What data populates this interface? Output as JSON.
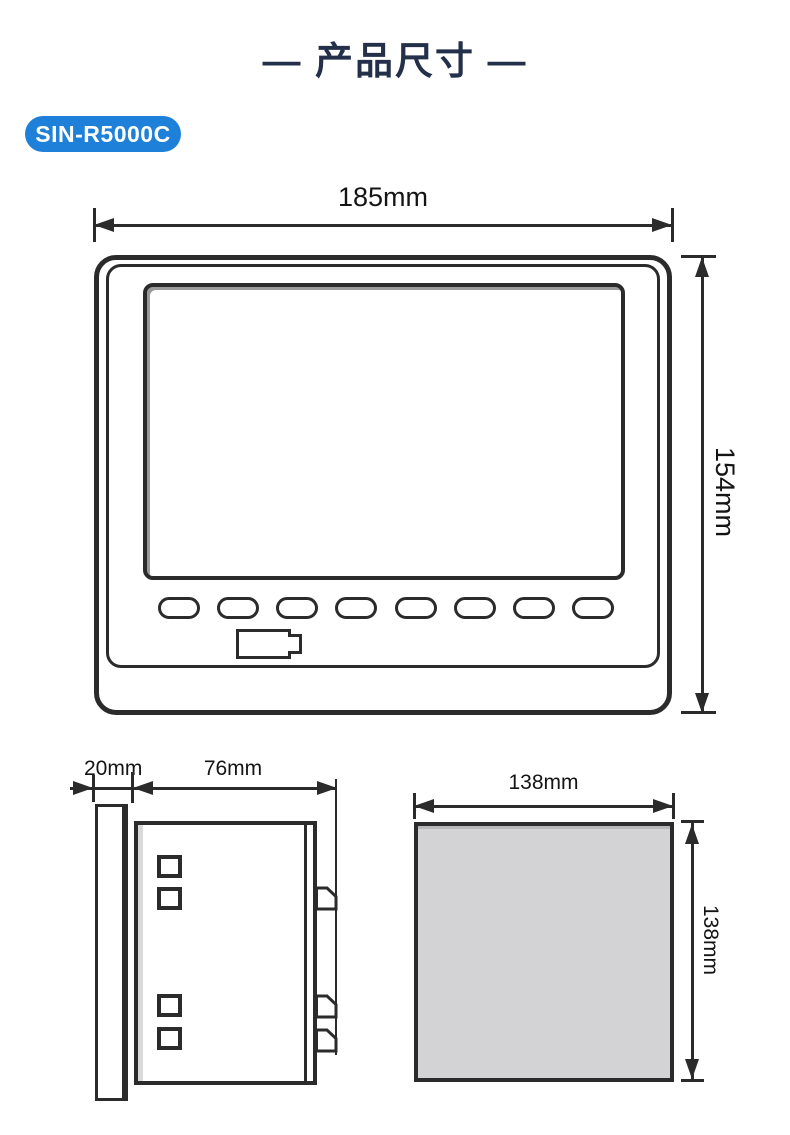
{
  "page": {
    "title": "— 产品尺寸 —",
    "model_badge": "SIN-R5000C"
  },
  "colors": {
    "title_text": "#243049",
    "badge_background": "#1E80D8",
    "badge_text": "#FFFFFF",
    "drawing_line": "#2B2B2B",
    "cutout_fill": "#D3D3D5"
  },
  "front_view": {
    "width_label": "185mm",
    "height_label": "154mm"
  },
  "side_view": {
    "flange_depth_label": "20mm",
    "body_depth_label": "76mm"
  },
  "cutout_view": {
    "width_label": "138mm",
    "height_label": "138mm"
  }
}
